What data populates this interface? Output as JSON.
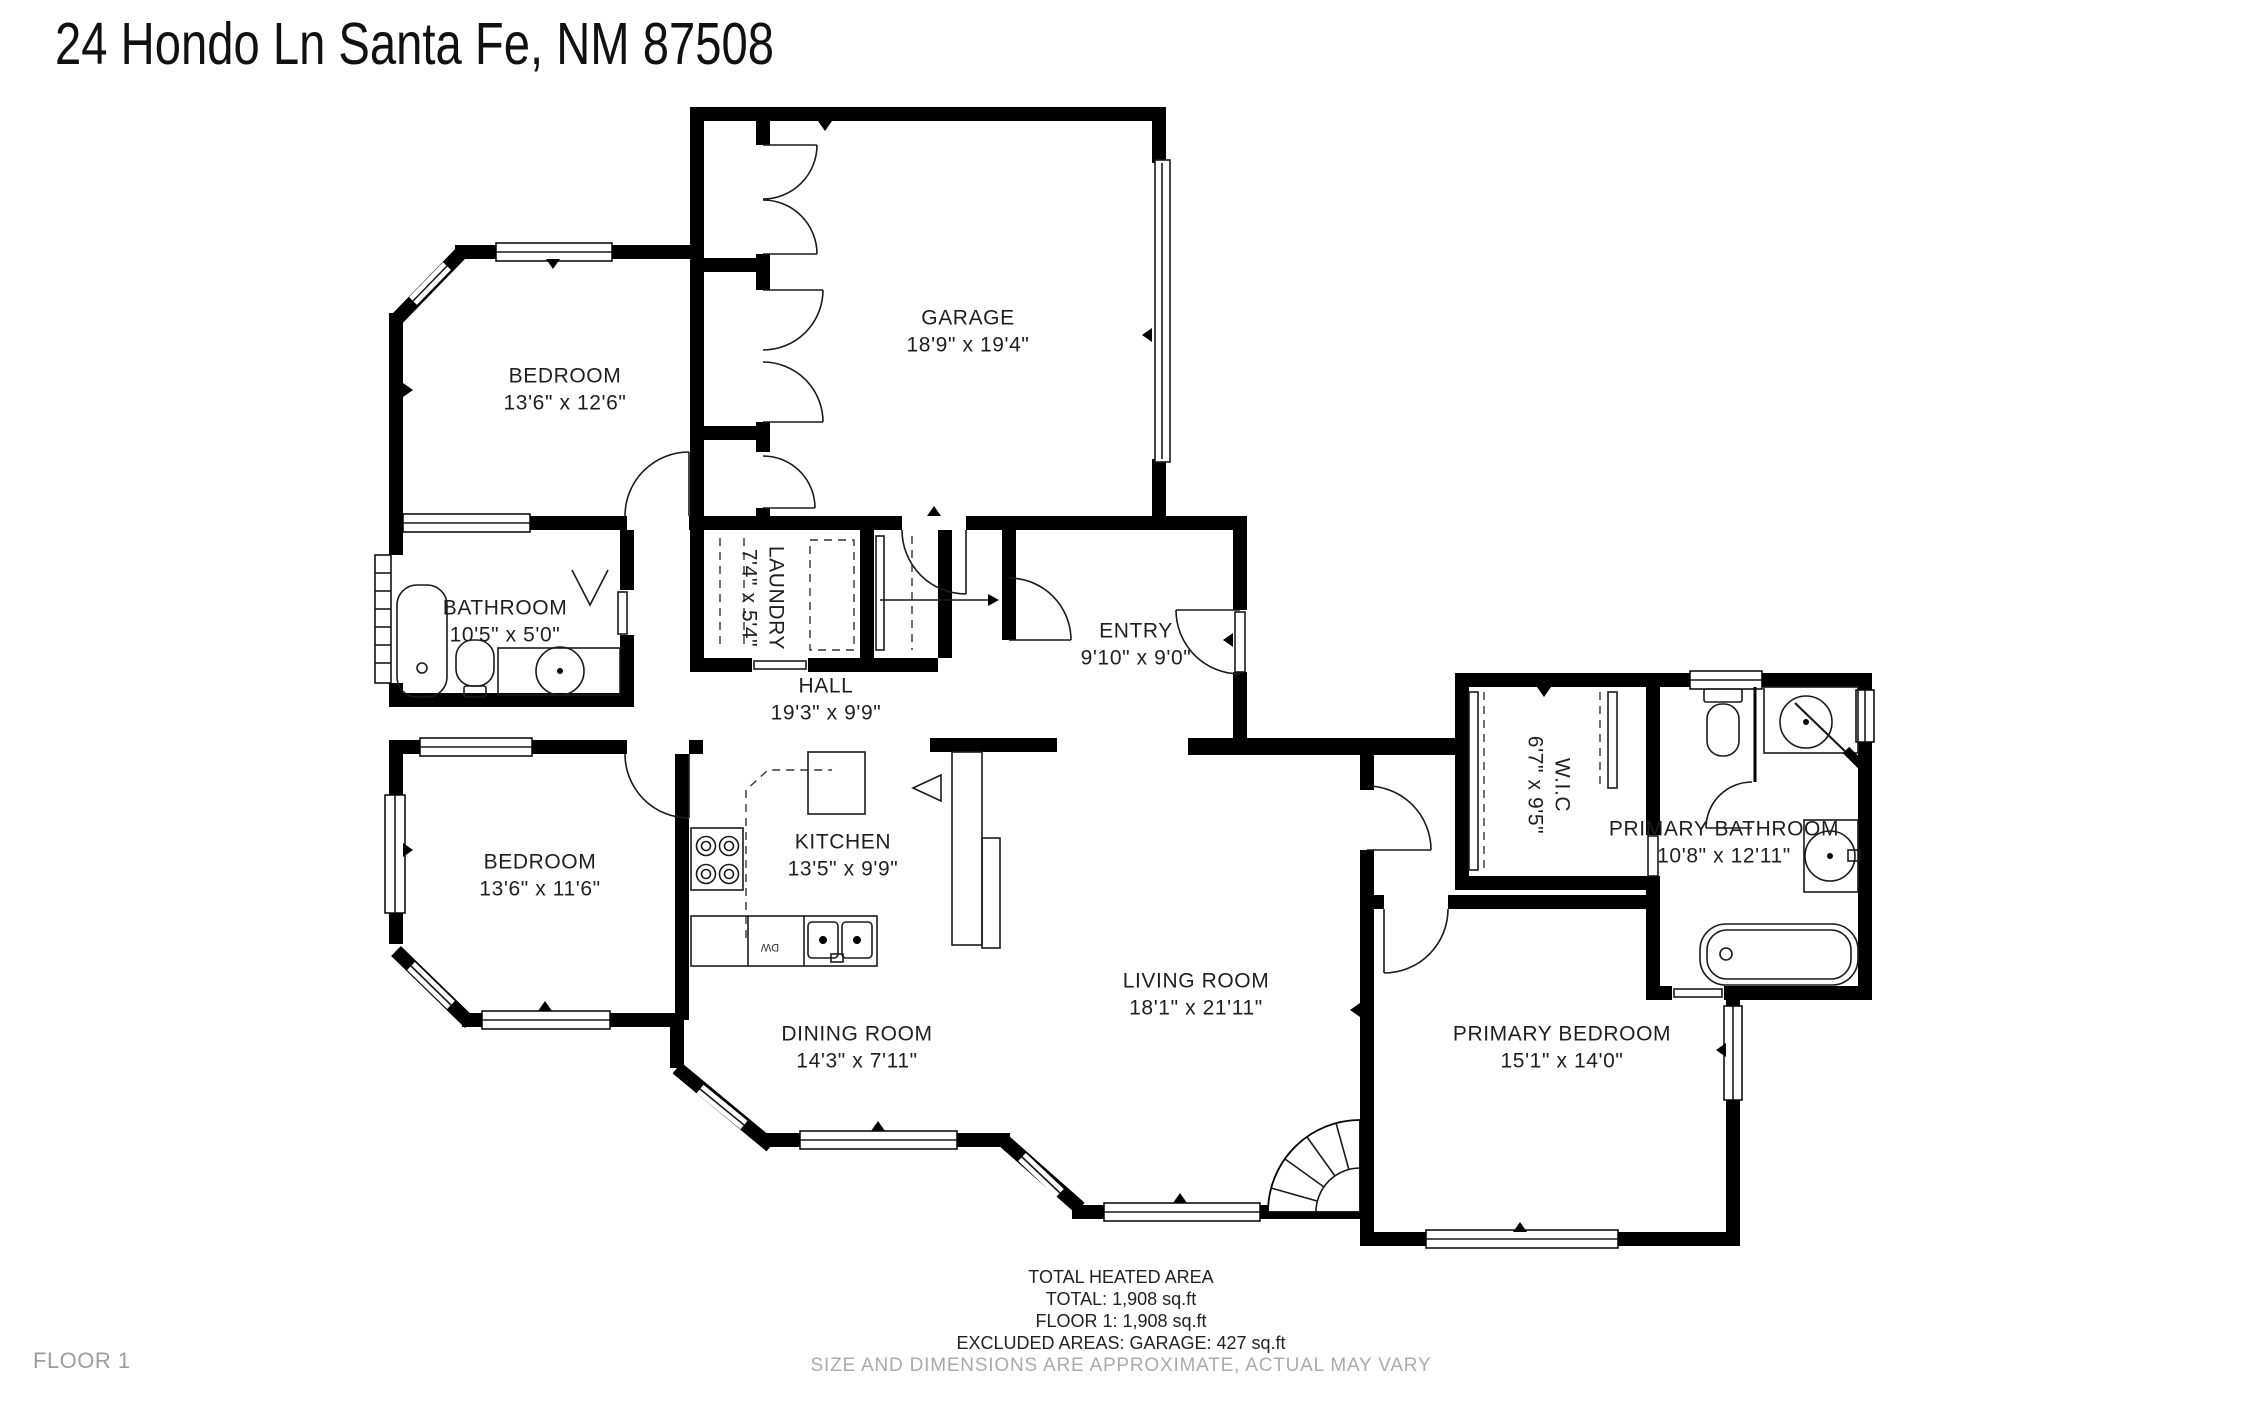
{
  "title": "24 Hondo Ln Santa Fe, NM 87508",
  "floor_label": "FLOOR 1",
  "rooms": {
    "garage": {
      "name": "GARAGE",
      "dims": "18'9\" x 19'4\""
    },
    "bedroom_top": {
      "name": "BEDROOM",
      "dims": "13'6\" x 12'6\""
    },
    "bathroom": {
      "name": "BATHROOM",
      "dims": "10'5\" x 5'0\""
    },
    "laundry": {
      "name": "LAUNDRY",
      "dims": "7'4\" x 5'4\""
    },
    "hall": {
      "name": "HALL",
      "dims": "19'3\" x 9'9\""
    },
    "entry": {
      "name": "ENTRY",
      "dims": "9'10\" x 9'0\""
    },
    "kitchen": {
      "name": "KITCHEN",
      "dims": "13'5\" x 9'9\""
    },
    "bedroom_bottom": {
      "name": "BEDROOM",
      "dims": "13'6\" x 11'6\""
    },
    "dining": {
      "name": "DINING ROOM",
      "dims": "14'3\" x 7'11\""
    },
    "living": {
      "name": "LIVING ROOM",
      "dims": "18'1\" x 21'11\""
    },
    "wic": {
      "name": "W.I.C",
      "dims": "6'7\" x 9'5\""
    },
    "primary_bath": {
      "name": "PRIMARY BATHROOM",
      "dims": "10'8\" x 12'11\""
    },
    "primary_bedroom": {
      "name": "PRIMARY BEDROOM",
      "dims": "15'1\" x 14'0\""
    }
  },
  "fixtures": {
    "dw_label": "DW"
  },
  "footer": {
    "heading": "TOTAL HEATED AREA",
    "total": "TOTAL: 1,908 sq.ft",
    "floor1": "FLOOR 1: 1,908 sq.ft",
    "excluded": "EXCLUDED AREAS: GARAGE: 427 sq.ft",
    "disclaimer": "SIZE AND DIMENSIONS ARE APPROXIMATE, ACTUAL MAY VARY"
  },
  "colors": {
    "wall": "#000000",
    "background": "#ffffff",
    "label": "#1f1f1f",
    "muted": "#ababab"
  }
}
